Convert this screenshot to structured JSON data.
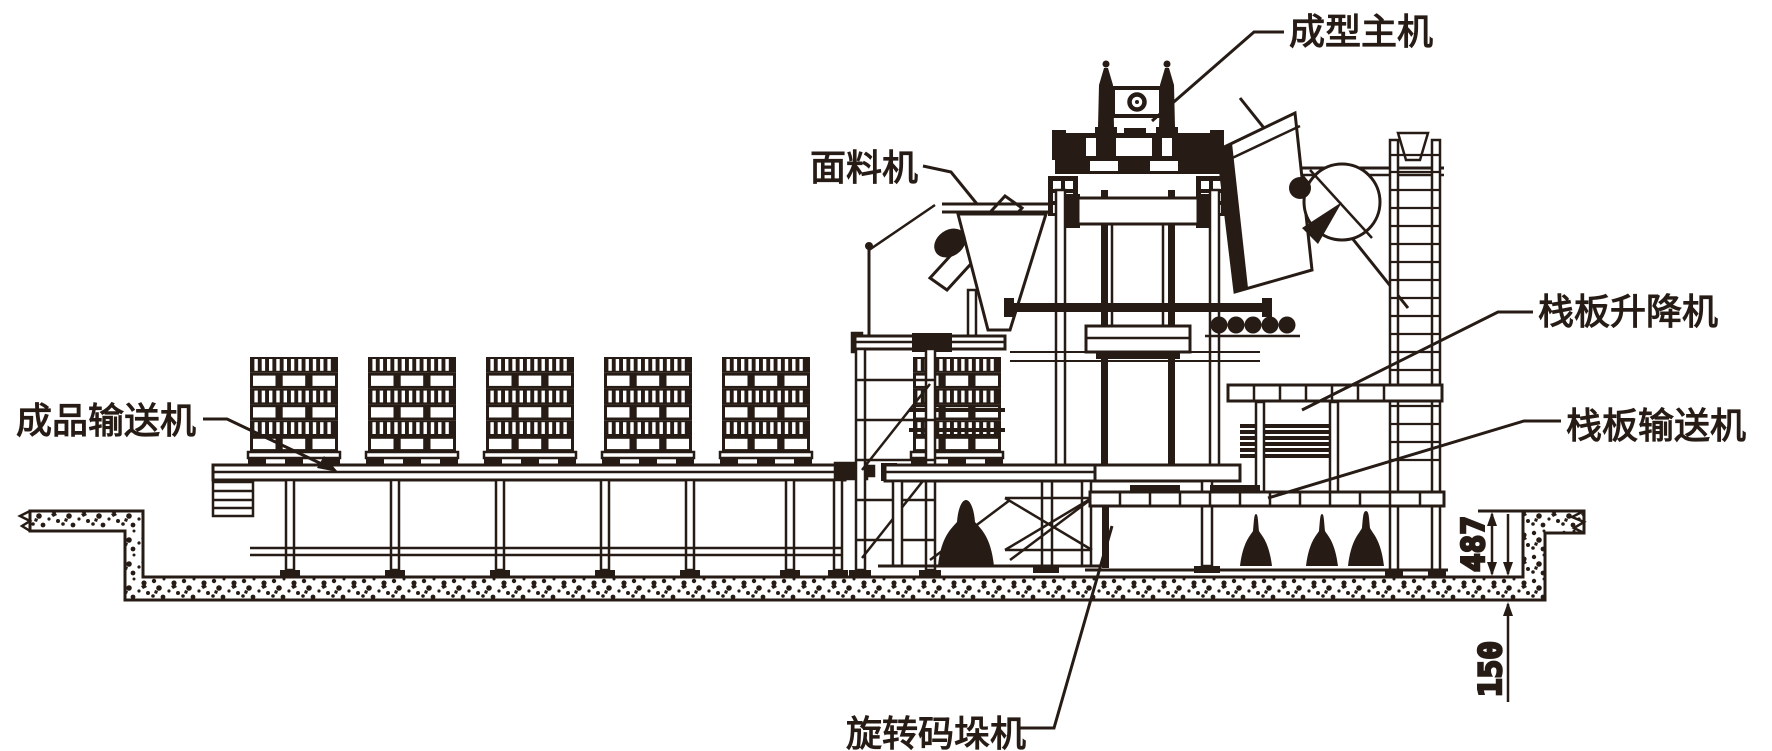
{
  "diagram": {
    "description": "Elevation line drawing of a concrete block production line installed in a foundation pit",
    "background": "#ffffff",
    "ink_color": "#271c15"
  },
  "labels": {
    "forming_machine": "成型主机",
    "face_material_machine": "面料机",
    "pallet_lifter": "栈板升降机",
    "pallet_conveyor": "栈板输送机",
    "product_conveyor": "成品输送机",
    "rotary_stacker": "旋转码垛机"
  },
  "dimensions": {
    "pit_depth": "487",
    "foundation_depth": "150"
  }
}
